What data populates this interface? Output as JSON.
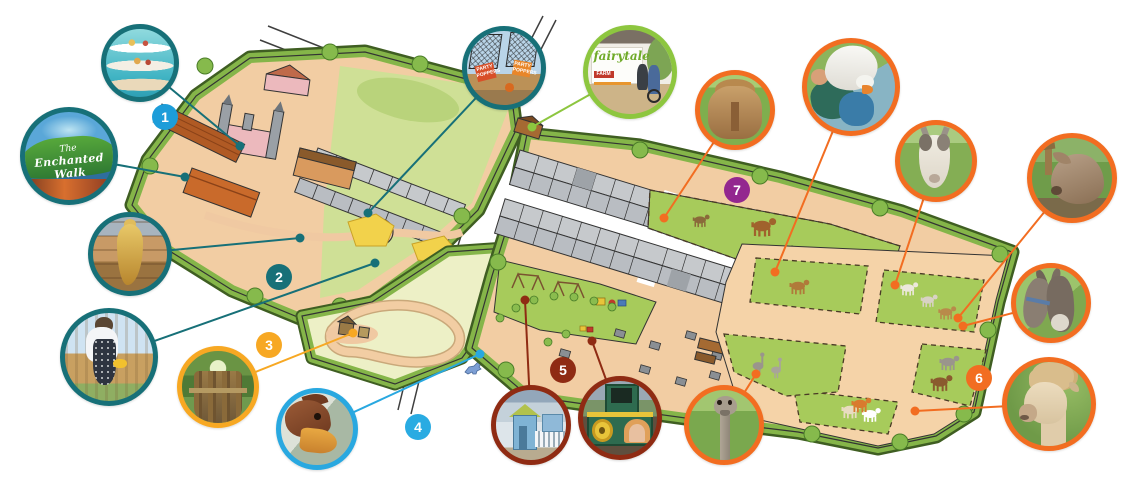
{
  "legend_badges": [
    {
      "number": "1",
      "color": "#1d9dd9"
    },
    {
      "number": "2",
      "color": "#177078"
    },
    {
      "number": "3",
      "color": "#f7a823"
    },
    {
      "number": "4",
      "color": "#29abe2"
    },
    {
      "number": "5",
      "color": "#8f2b13"
    },
    {
      "number": "6",
      "color": "#f26d21"
    },
    {
      "number": "7",
      "color": "#93278f"
    }
  ],
  "photo_callouts": [
    {
      "id": "afternoon-tea",
      "subject": "afternoon-tea-cake-stand-photo",
      "ring_color": "#177078"
    },
    {
      "id": "enchanted-walk-sign",
      "subject": "enchanted-walk-entrance-sign-photo",
      "ring_color": "#177078"
    },
    {
      "id": "mermaid",
      "subject": "golden-mermaid-statue-photo",
      "ring_color": "#177078"
    },
    {
      "id": "girl-watering",
      "subject": "child-playing-with-cup-photo",
      "ring_color": "#177078"
    },
    {
      "id": "treehouse",
      "subject": "wooden-treehouse-walkway-photo",
      "ring_color": "#f7a823"
    },
    {
      "id": "dragon",
      "subject": "dragon-sculpture-head-photo",
      "ring_color": "#29a8e0"
    },
    {
      "id": "party-poppers",
      "subject": "party-poppers-nets-photo",
      "ring_color": "#177078"
    },
    {
      "id": "fairytale-entrance",
      "subject": "fairytale-farm-entrance-photo",
      "ring_color": "#8dc63f"
    },
    {
      "id": "pony",
      "subject": "shetland-pony-photo",
      "ring_color": "#f26d21"
    },
    {
      "id": "goose",
      "subject": "goose-feeding-photo",
      "ring_color": "#f26d21"
    },
    {
      "id": "goat",
      "subject": "goat-photo",
      "ring_color": "#f26d21"
    },
    {
      "id": "pig",
      "subject": "pig-photo",
      "ring_color": "#f26d21"
    },
    {
      "id": "donkeys",
      "subject": "donkeys-photo",
      "ring_color": "#f26d21"
    },
    {
      "id": "alpaca",
      "subject": "alpaca-photo",
      "ring_color": "#f26d21"
    },
    {
      "id": "ostrich",
      "subject": "ostrich-photo",
      "ring_color": "#f26d21"
    },
    {
      "id": "playhouse",
      "subject": "blue-playhouse-photo",
      "ring_color": "#8f2b13"
    },
    {
      "id": "train",
      "subject": "green-play-train-photo",
      "ring_color": "#8f2b13"
    }
  ],
  "signs": {
    "enchanted_walk": {
      "prefix": "The",
      "name": "Enchanted Walk"
    },
    "fairytale_logo": {
      "word": "fairytale",
      "farm": "FARM"
    },
    "party_poppers": {
      "label": "PARTY POPPERS"
    }
  }
}
